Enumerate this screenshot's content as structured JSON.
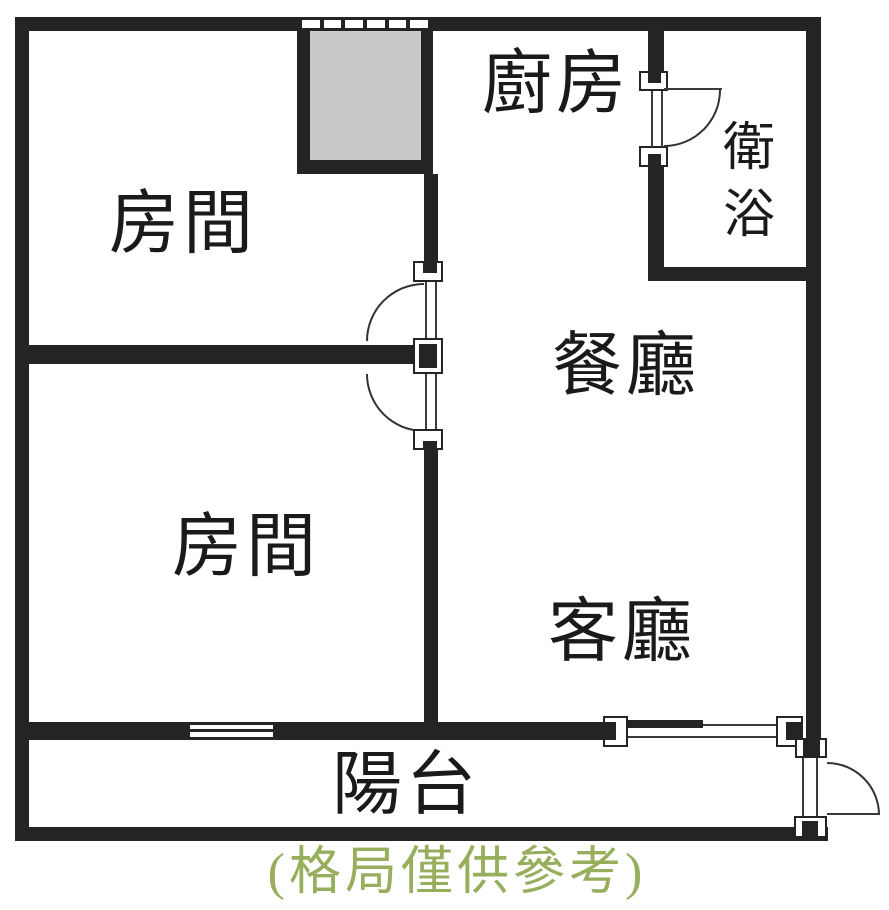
{
  "plan": {
    "title_caption": "(格局僅供參考)",
    "rooms": {
      "kitchen": {
        "label": "廚房"
      },
      "bathroom": {
        "label": "衛浴"
      },
      "bedroom_top": {
        "label": "房間"
      },
      "dining": {
        "label": "餐廳"
      },
      "bedroom_bottom": {
        "label": "房間"
      },
      "living": {
        "label": "客廳"
      },
      "balcony": {
        "label": "陽台"
      }
    },
    "colors": {
      "wall": "#242424",
      "shaft_fill": "#c9c9c9",
      "label_text": "#1a1a1a",
      "caption_text": "#97ae5c",
      "background": "#ffffff"
    }
  }
}
